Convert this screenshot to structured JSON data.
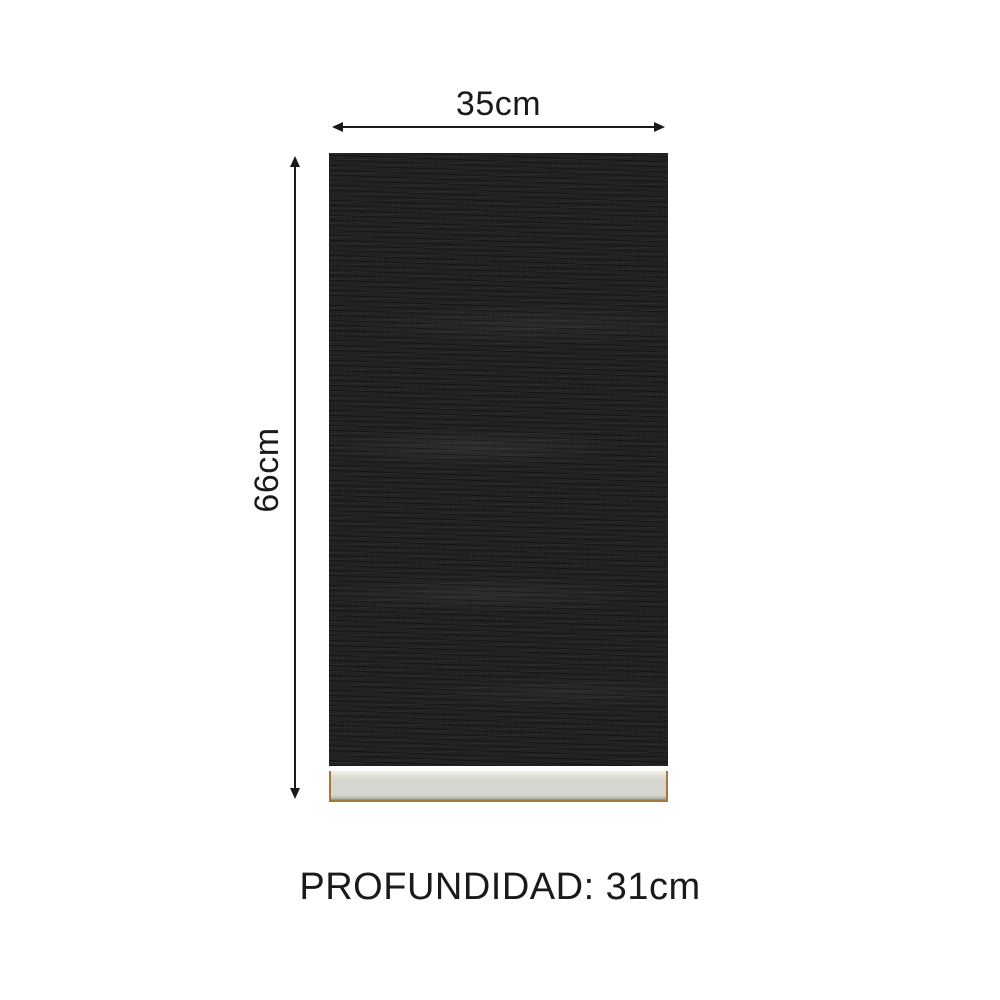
{
  "diagram": {
    "title": "cabinet-door-dimension-diagram",
    "width_label": "35cm",
    "height_label": "66cm",
    "depth_label": "PROFUNDIDAD: 31cm",
    "colors": {
      "background": "#ffffff",
      "text": "#1a1a1a",
      "arrow": "#1a1a1a",
      "panel": "#242424",
      "base": "#d6d6d0",
      "base_edge": "#a07a38"
    }
  }
}
